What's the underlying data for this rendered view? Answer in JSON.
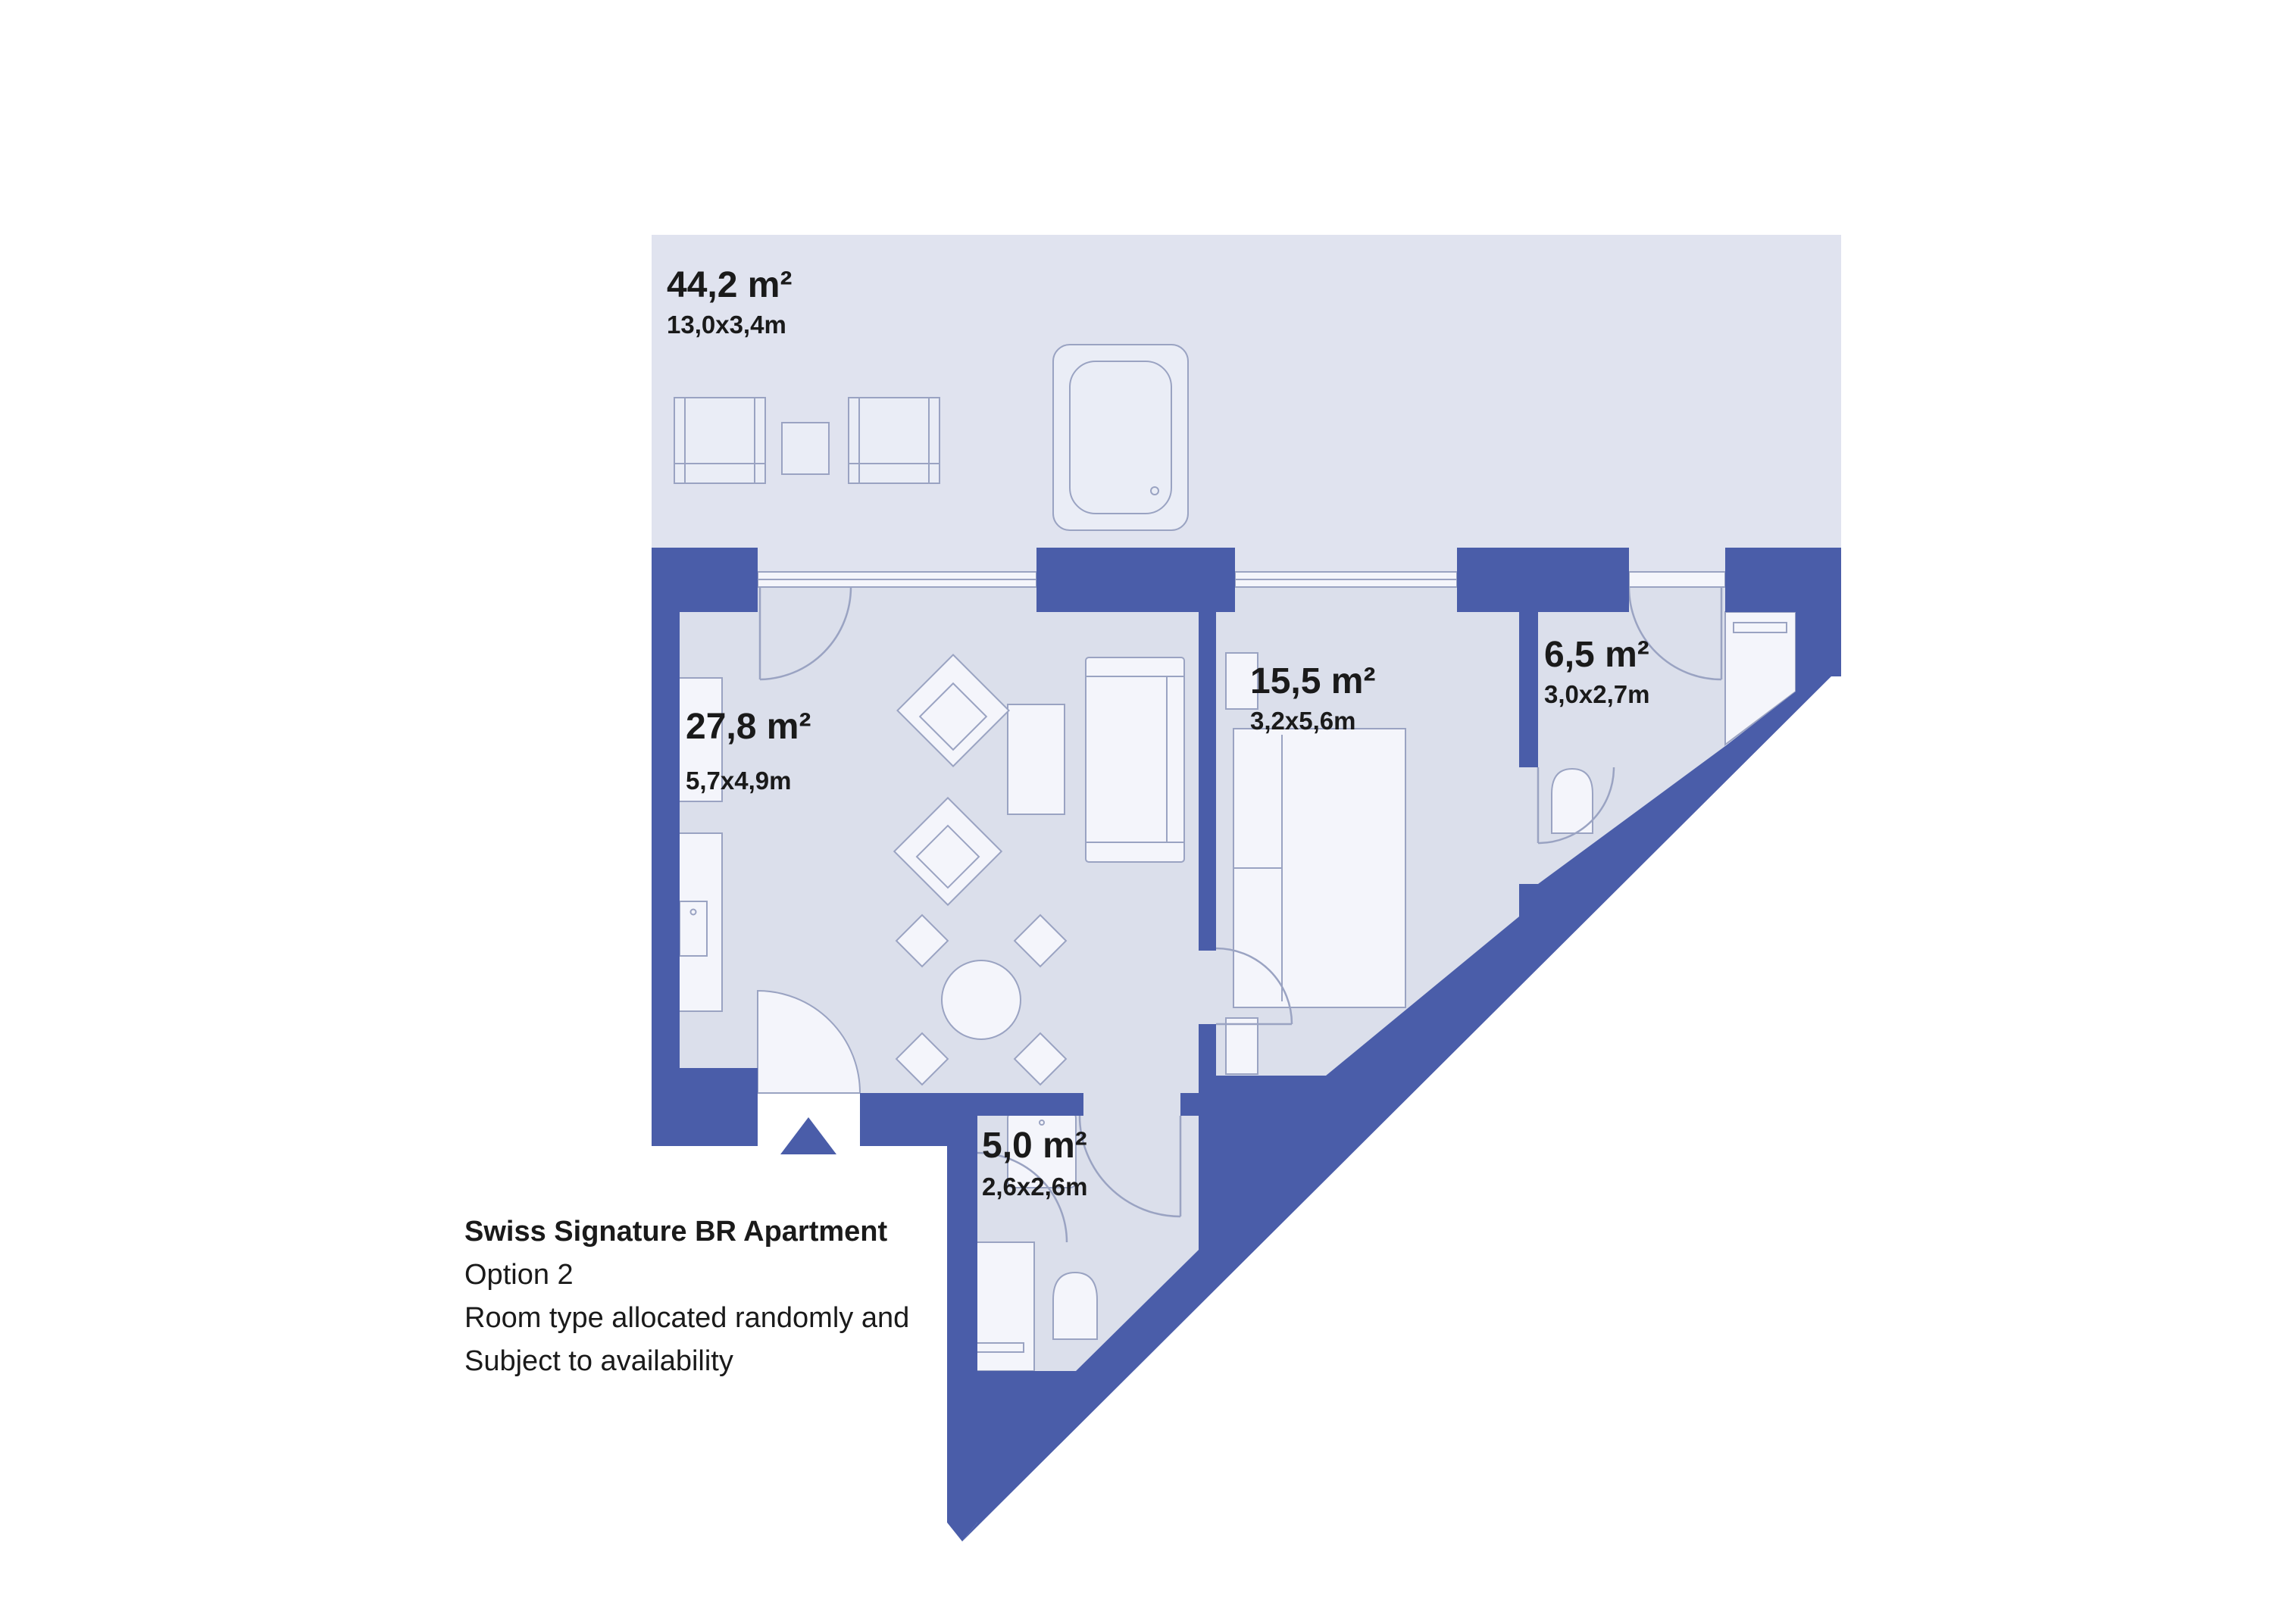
{
  "colors": {
    "wall": "#4a5da9",
    "terrace": "#e0e3ef",
    "room": "#dbdfeb",
    "furniture": "#eaedf6",
    "fixture": "#f4f5fb",
    "outline": "#9aa3c2",
    "text": "#1a1a1a"
  },
  "plan": {
    "terrace": {
      "area": "44,2 m²",
      "dims": "13,0x3,4m"
    },
    "living_room": {
      "area": "27,8 m²",
      "dims": "5,7x4,9m"
    },
    "bedroom": {
      "area": "15,5 m²",
      "dims": "3,2x5,6m"
    },
    "bathroom": {
      "area": "6,5 m²",
      "dims": "3,0x2,7m"
    },
    "shower_room": {
      "area": "5,0 m²",
      "dims": "2,6x2,6m"
    }
  },
  "caption": {
    "title": "Swiss Signature BR Apartment",
    "line2": "Option 2",
    "line3": "Room type allocated randomly and",
    "line4": "Subject to availability"
  }
}
